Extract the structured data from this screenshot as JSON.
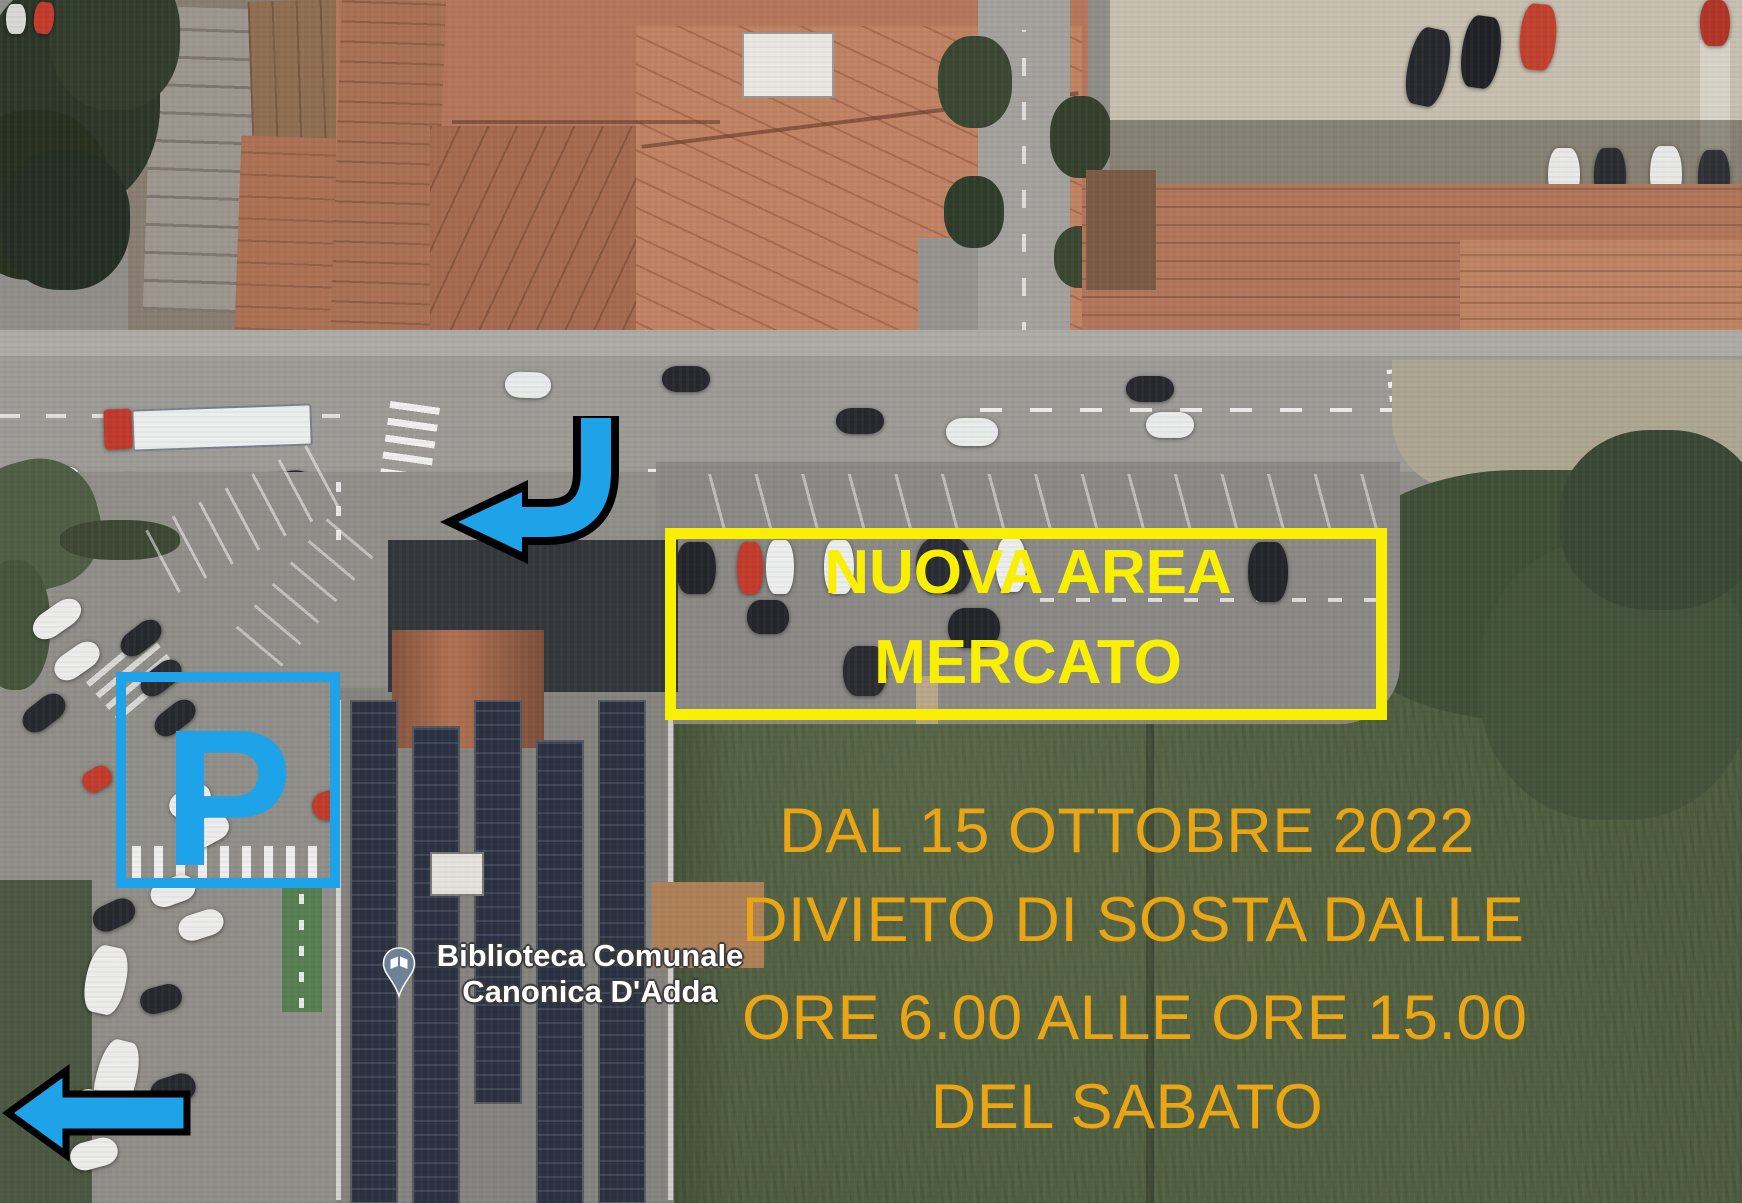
{
  "poi": {
    "pin_icon": "open-book-pin-icon",
    "name_line1": "Biblioteca Comunale",
    "name_line2": "Canonica D'Adda"
  },
  "annotations": {
    "market_area_box": {
      "line1": "NUOVA AREA",
      "line2": "MERCATO",
      "border_color": "#f9ef02",
      "text_color": "#f9ef02"
    },
    "notice": {
      "lines": [
        "DAL 15 OTTOBRE 2022",
        "DIVIETO DI SOSTA DALLE",
        "ORE 6.00 ALLE ORE 15.00",
        "DEL SABATO"
      ],
      "text_color": "#e9a514"
    },
    "parking_box": {
      "label": "P",
      "color": "#1fa3e8"
    },
    "arrows": {
      "curved_arrow_icon": "curved-turn-left-arrow-icon",
      "straight_arrow_icon": "left-arrow-icon",
      "fill_color": "#1fa3e8",
      "outline_color": "#000000"
    }
  }
}
